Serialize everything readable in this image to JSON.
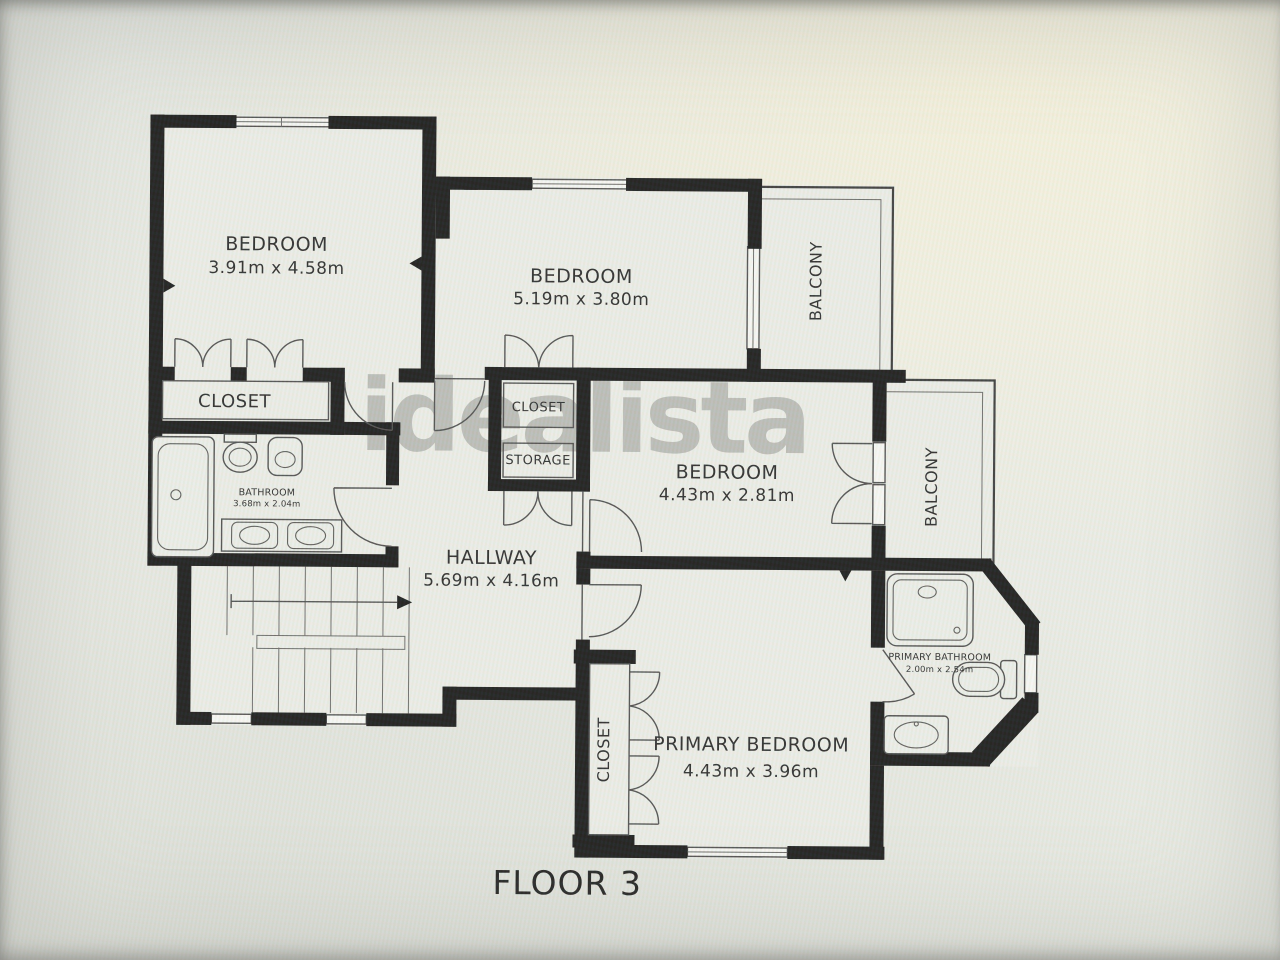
{
  "floor_plan": {
    "floor_label": "FLOOR 3",
    "watermark": "idealista",
    "rooms": {
      "bedroom_top_left": {
        "label": "BEDROOM",
        "dimensions": "3.91m x 4.58m"
      },
      "bedroom_top_middle": {
        "label": "BEDROOM",
        "dimensions": "5.19m x 3.80m"
      },
      "bedroom_middle": {
        "label": "BEDROOM",
        "dimensions": "4.43m x 2.81m"
      },
      "primary_bedroom": {
        "label": "PRIMARY BEDROOM",
        "dimensions": "4.43m x 3.96m"
      },
      "hallway": {
        "label": "HALLWAY",
        "dimensions": "5.69m x 4.16m"
      },
      "bathroom": {
        "label": "BATHROOM",
        "dimensions": "3.68m x 2.04m"
      },
      "primary_bathroom": {
        "label": "PRIMARY BATHROOM",
        "dimensions": "2.00m x 2.54m"
      },
      "closet_bedroom_top_left": {
        "label": "CLOSET"
      },
      "closet_hall": {
        "label": "CLOSET"
      },
      "storage_hall": {
        "label": "STORAGE"
      },
      "closet_primary": {
        "label": "CLOSET"
      },
      "balcony_upper": {
        "label": "BALCONY"
      },
      "balcony_lower": {
        "label": "BALCONY"
      }
    },
    "colors": {
      "walls": "#1a1a1a",
      "thin_lines": "#4f4f4f",
      "text": "#2b2b2b",
      "paper": "#e9eae4",
      "watermark": "#8c8c89"
    }
  }
}
